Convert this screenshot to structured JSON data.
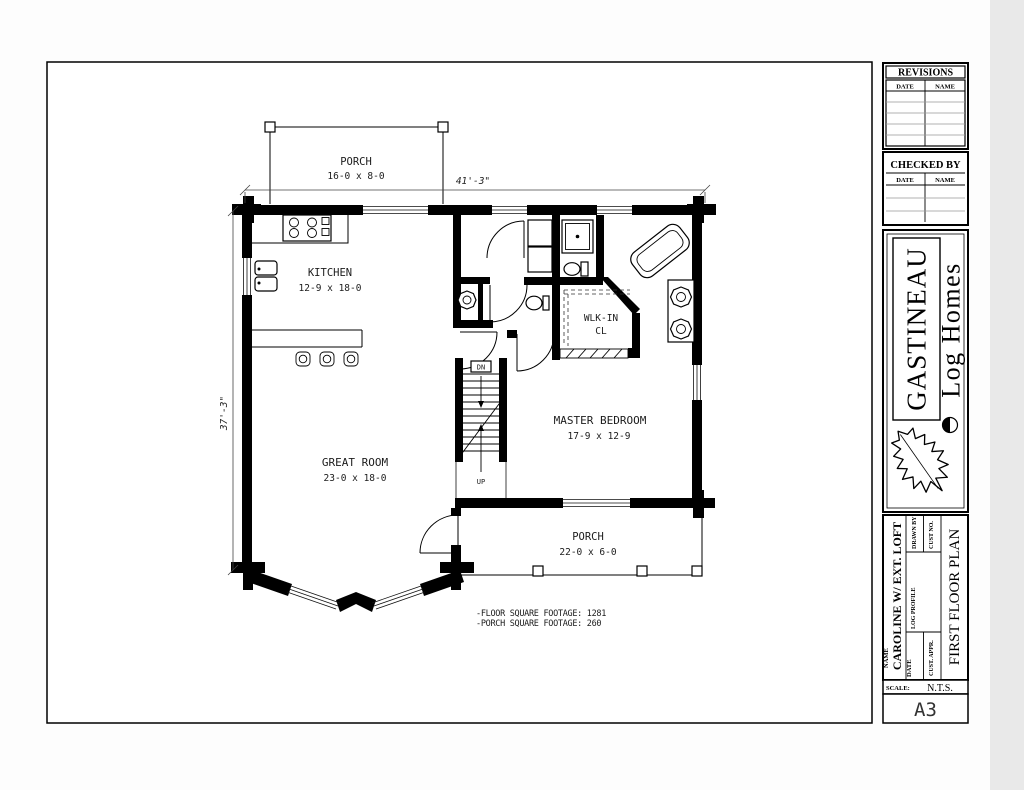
{
  "sheet": {
    "revisions": {
      "title": "REVISIONS",
      "date_col": "DATE",
      "name_col": "NAME"
    },
    "checked_by": {
      "title": "CHECKED BY",
      "date_col": "DATE",
      "name_col": "NAME"
    },
    "logo": {
      "brand": "GASTINEAU",
      "tagline": "Log Homes"
    },
    "info": {
      "name_label": "NAME",
      "project_name": "CAROLINE W/ EXT. LOFT",
      "date_label": "DATE",
      "drawn_by_label": "DRAWN BY",
      "cust_no_label": "CUST NO.",
      "log_profile_label": "LOG PROFILE",
      "cust_appr_label": "CUST. APPR.",
      "sheet_title": "FIRST FLOOR PLAN",
      "scale_label": "SCALE:",
      "scale_value": "N.T.S.",
      "sheet_number": "A3"
    }
  },
  "plan": {
    "porch_top": {
      "name": "PORCH",
      "dims": "16-0 x 8-0"
    },
    "kitchen": {
      "name": "KITCHEN",
      "dims": "12-9 x 18-0"
    },
    "walkin": {
      "line1": "WLK-IN",
      "line2": "CL"
    },
    "master_bedroom": {
      "name": "MASTER BEDROOM",
      "dims": "17-9 x 12-9"
    },
    "great_room": {
      "name": "GREAT ROOM",
      "dims": "23-0 x 18-0"
    },
    "porch_bottom": {
      "name": "PORCH",
      "dims": "22-0 x 6-0"
    },
    "stairs": {
      "up": "UP",
      "down": "DN"
    },
    "dim_width": "41'-3\"",
    "dim_height": "37'-3\"",
    "notes": {
      "floor": "-FLOOR SQUARE FOOTAGE:  1281",
      "porch": "-PORCH SQUARE FOOTAGE:  260"
    }
  },
  "colors": {
    "ink": "#000000",
    "paper": "#ffffff",
    "page_edge": "#e9e9e9"
  }
}
